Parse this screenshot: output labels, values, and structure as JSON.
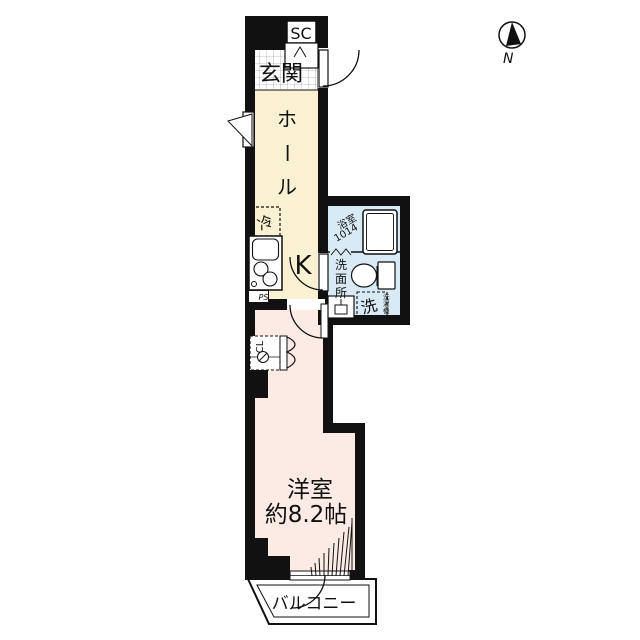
{
  "plan": {
    "title": "1K apartment floor plan",
    "north_label": "N",
    "entrance": {
      "label": "玄関",
      "shoe_closet_label": "SC"
    },
    "hall": {
      "chars": [
        "ホ",
        "ー",
        "ル"
      ]
    },
    "kitchen": {
      "label": "K",
      "fridge_label": "冷",
      "pipe_space_label": "PS"
    },
    "bathroom": {
      "label": "浴室",
      "size": "1014"
    },
    "washroom": {
      "chars": [
        "洗",
        "面",
        "所"
      ]
    },
    "laundry": {
      "label": "洗",
      "machine_chars": [
        "洗",
        "濯",
        "機"
      ]
    },
    "closet": {
      "label": "CL"
    },
    "room": {
      "name": "洋室",
      "size": "約8.2帖"
    },
    "balcony": {
      "label": "バルコニー"
    },
    "colors": {
      "wall": "#111111",
      "hall_floor": "#faf0d2",
      "room_floor": "#fcebe5",
      "bath_floor": "#d8eaf5",
      "tile_line": "#8a8a8a"
    }
  }
}
